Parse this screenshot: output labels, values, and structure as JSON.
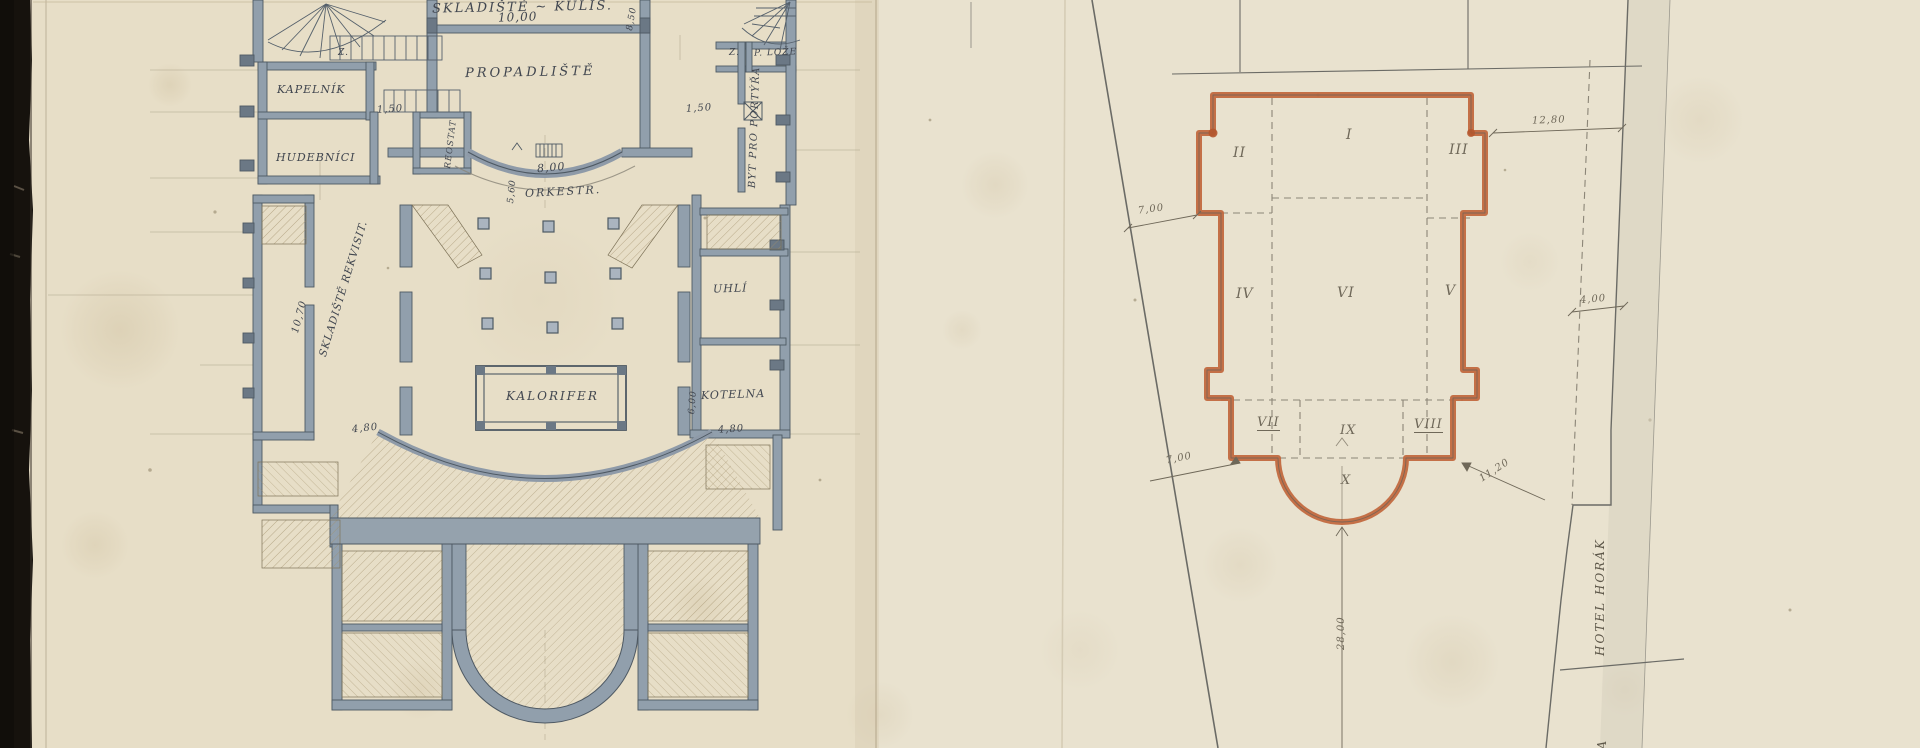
{
  "left_plan": {
    "rooms": {
      "skladiste_kulis": "SKLADIŠTĚ ~ KULIS.",
      "propadliste": "PROPADLIŠTĚ",
      "kapelnik": "KAPELNÍK",
      "hudebnici": "HUDEBNÍCI",
      "reostat": "REOSTAT",
      "orkestr": "ORKESTR.",
      "skladiste_rekvisit": "SKLADIŠTĚ REKVISIT.",
      "kalorifer": "KALORIFER",
      "uhli": "UHLÍ",
      "kotelna": "KOTELNA",
      "byt_pro_portyra": "BYT PRO PORTÝŘA",
      "p_loze": "P. LOŽE",
      "z_room_left": "Z.",
      "z_room_right": "Z."
    },
    "dimensions": {
      "kulis_width": "10,00",
      "kulis_depth": "8,50",
      "kapelnik_door": "1,50",
      "portyr_door": "1,50",
      "orkestr_width": "8,00",
      "orkestr_depth": "5,60",
      "rekvisit_length": "10,70",
      "rekvisit_end": "4,80",
      "kotelna_width": "4,80",
      "kotelna_depth": "6,00"
    }
  },
  "right_plan": {
    "numerals": {
      "i": "I",
      "ii": "II",
      "iii": "III",
      "iv": "IV",
      "v": "V",
      "vi": "VI",
      "vii": "VII",
      "viii": "VIII",
      "ix": "IX",
      "x": "X"
    },
    "dimensions": {
      "northwest_offset": "7,00",
      "northeast_offset": "12,80",
      "east_offset": "4,00",
      "southwest_offset": "7,00",
      "southeast_offset": "11,20",
      "south_depth": "28,00"
    },
    "labels": {
      "hotel": "HOTEL HORÁK",
      "street_cut": "NA"
    }
  }
}
